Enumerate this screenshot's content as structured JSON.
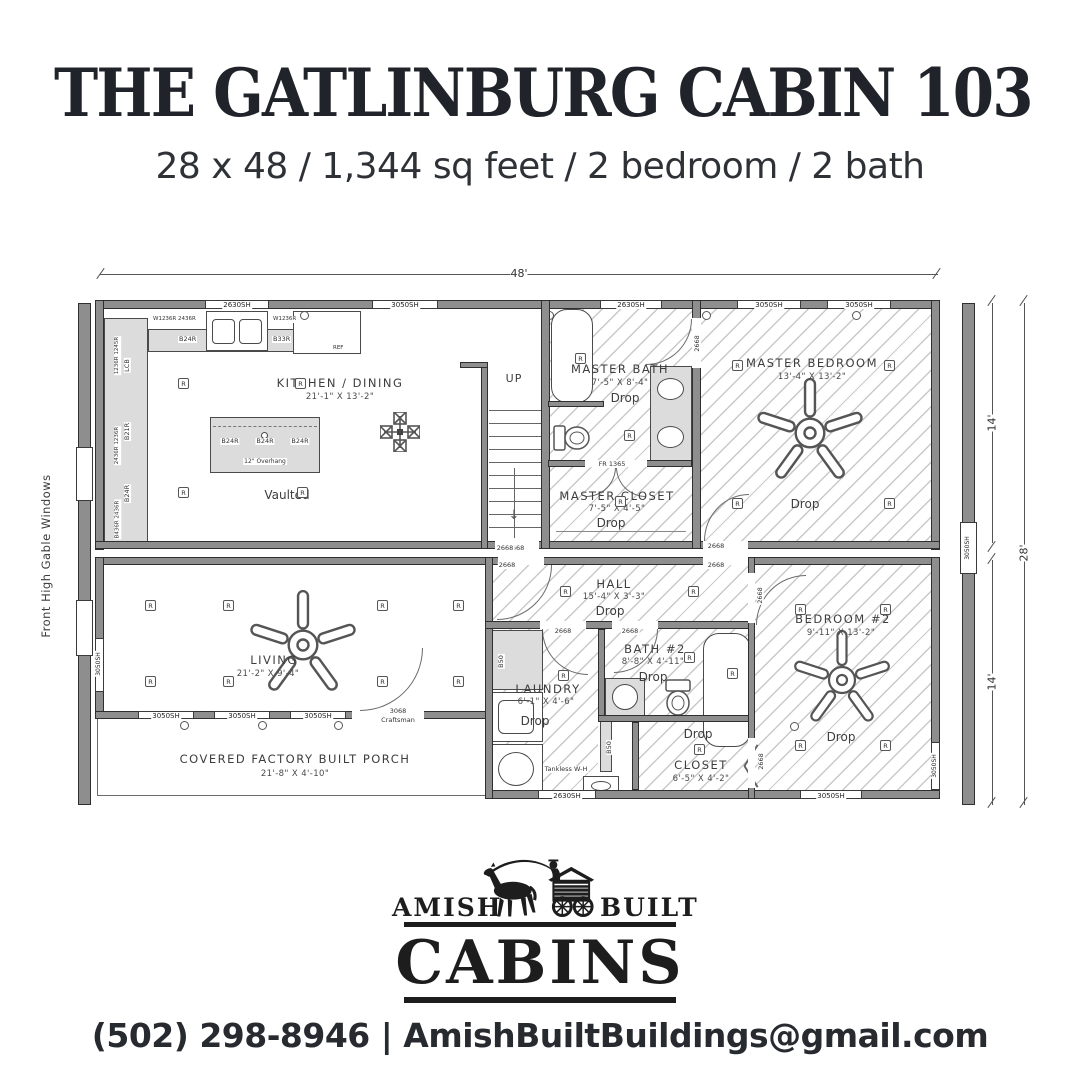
{
  "header": {
    "title": "THE GATLINBURG CABIN 103",
    "subtitle": "28 x 48 / 1,344 sq feet / 2 bedroom / 2 bath"
  },
  "plan": {
    "dim_width": "48'",
    "dim_right_top": "14'",
    "dim_right_bottom": "14'",
    "dim_right_total": "28'",
    "left_note": "Front High Gable Windows",
    "labels": {
      "up": "UP",
      "drop": "Drop",
      "vaulted": "Vaulted",
      "recessed": "R",
      "win2630": "2630SH",
      "win3050": "3050SH",
      "door2668": "2668",
      "door3068a": "3068",
      "door3068b": "Craftsman",
      "fr": "FR 1365",
      "ref": "REF",
      "tankless": "Tankless W-H",
      "b24r": "B24R",
      "b33r": "B33R",
      "b21r": "B21R",
      "lcb": "LCB",
      "b50": "B50",
      "cab_top_left": "W1236R 2436R",
      "cab_top_right": "W1236R",
      "cab_left_1": "1236R 1245R",
      "cab_left_2": "2436R 1236R",
      "cab_left_3": "B436R 2436R",
      "island_overhang": "12\" Overhang",
      "down_arrow": "↓"
    },
    "rooms": {
      "kitchen": {
        "name": "KITCHEN / DINING",
        "dims": "21'-1\" X 13'-2\""
      },
      "master_bath": {
        "name": "MASTER BATH",
        "dims": "7'-5\" X 8'-4\""
      },
      "master_closet": {
        "name": "MASTER CLOSET",
        "dims": "7'-5\" X 4'-5\""
      },
      "master_bedroom": {
        "name": "MASTER BEDROOM",
        "dims": "13'-4\" X 13'-2\""
      },
      "hall": {
        "name": "HALL",
        "dims": "15'-4\" X 3'-3\""
      },
      "living": {
        "name": "LIVING",
        "dims": "21'-2\" X 9'-4\""
      },
      "laundry": {
        "name": "LAUNDRY",
        "dims": "6'-1\" X 4'-6\""
      },
      "bath2": {
        "name": "BATH #2",
        "dims": "8'-8\" X 4'-11\""
      },
      "closet2": {
        "name": "CLOSET",
        "dims": "6'-5\" X 4'-2\""
      },
      "bedroom2": {
        "name": "BEDROOM #2",
        "dims": "9'-11\" X 13'-2\""
      },
      "porch": {
        "name": "COVERED FACTORY BUILT PORCH",
        "dims": "21'-8\" X 4'-10\""
      }
    }
  },
  "logo": {
    "word_left": "AMISH",
    "word_right": "BUILT",
    "word_main": "CABINS"
  },
  "footer": {
    "contact": "(502) 298-8946 | AmishBuiltBuildings@gmail.com"
  }
}
